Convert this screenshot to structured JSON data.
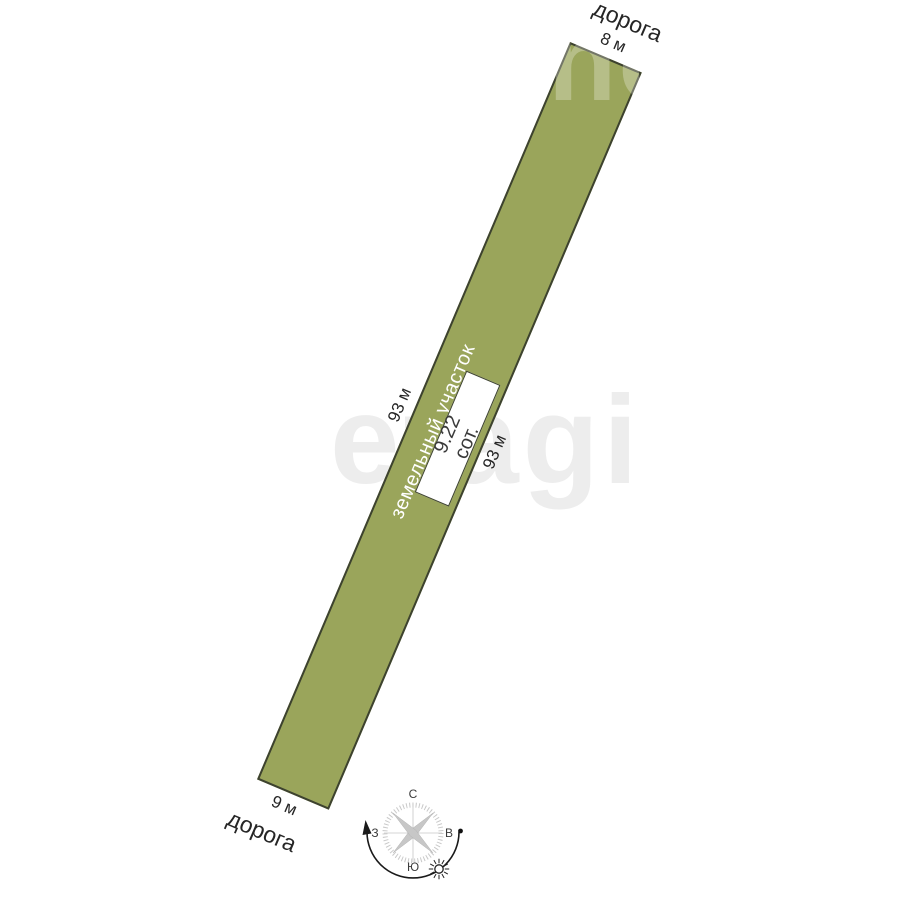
{
  "plot": {
    "label": "земельный участок",
    "area_value": "9.22",
    "area_unit": "сот.",
    "fill_color": "#9aa55b",
    "border_color": "#3d422f"
  },
  "dimensions": {
    "top": "8 м",
    "bottom": "9 м",
    "left": "93 м",
    "right": "93 м"
  },
  "roads": {
    "top": "дорога",
    "bottom": "дорога"
  },
  "compass": {
    "north": "С",
    "south": "Ю",
    "west": "З",
    "east": "В"
  },
  "watermark": {
    "center": "etagi",
    "top_partial": "no"
  }
}
